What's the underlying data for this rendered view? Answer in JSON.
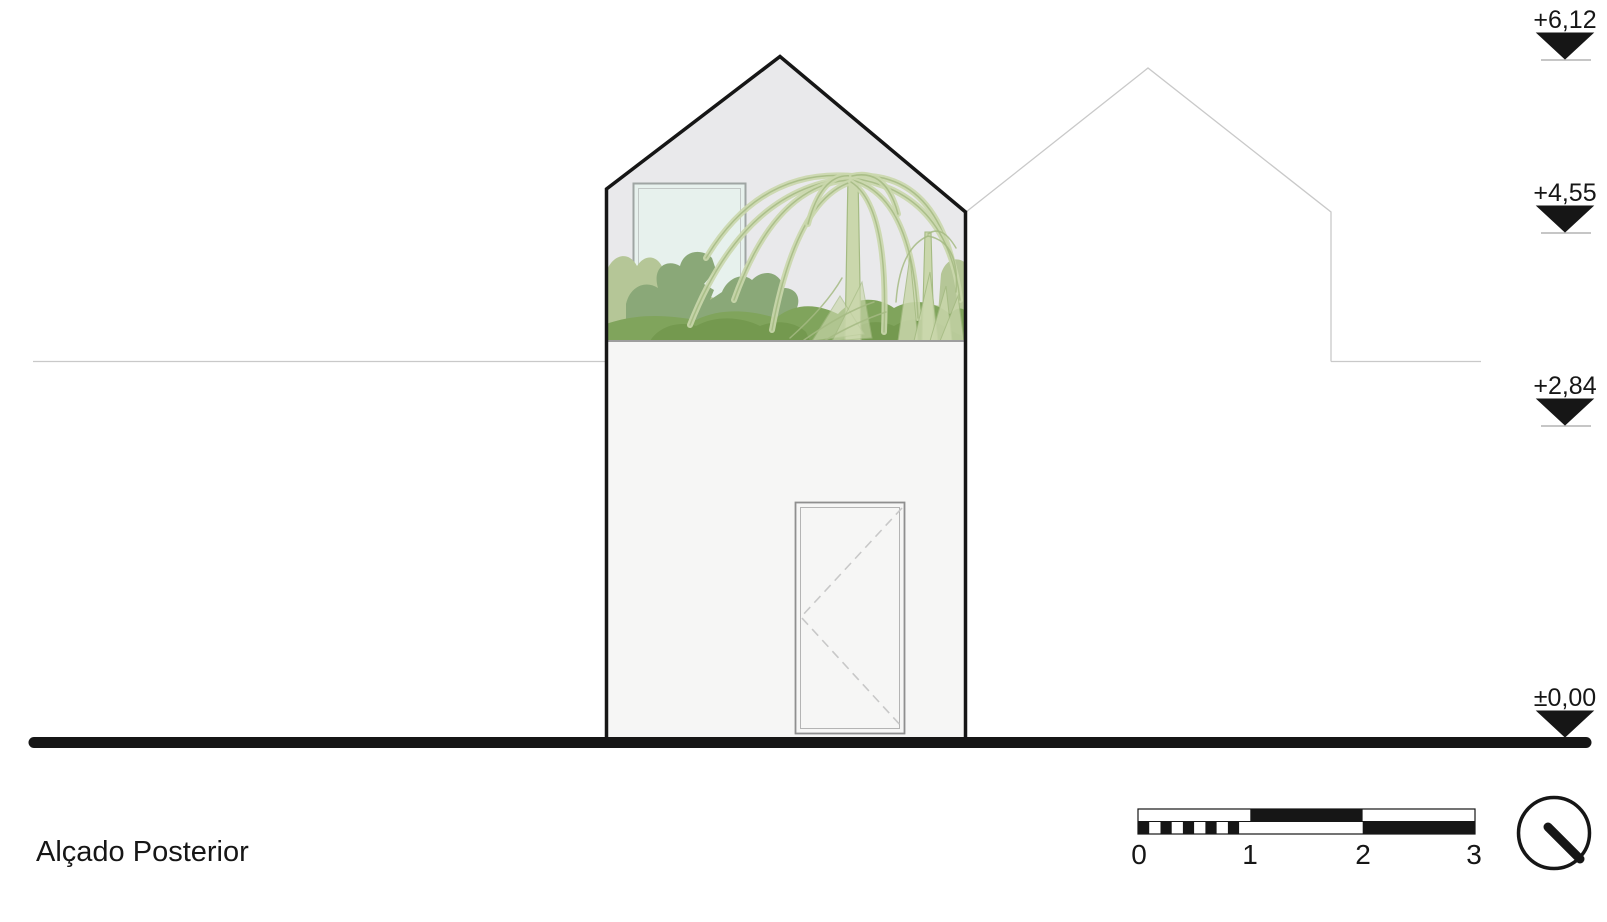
{
  "title": "Alçado Posterior",
  "levels": [
    {
      "label": "+6,12"
    },
    {
      "label": "+4,55"
    },
    {
      "label": "+2,84"
    },
    {
      "label": "±0,00"
    }
  ],
  "scale_bar": {
    "ticks": [
      "0",
      "1",
      "2",
      "3"
    ]
  },
  "colors": {
    "ink": "#161616",
    "faint": "#c9c9c9",
    "ref_line": "#b3b3b3",
    "floor_line": "#9e9e9e",
    "gable_fill": "#e9e9eb",
    "wall_fill": "#f6f6f5",
    "window_fill": "#e7f1ed",
    "window_frame": "#9fa5a3",
    "door_frame": "#8f8f8f",
    "door_dash": "#c8c8c8",
    "green_light": "#b5c697",
    "green_medium": "#8aa878",
    "green_band": "#80a45c",
    "green_dark": "#74994f",
    "palm_fill": "#cad7ac",
    "palm_stroke": "#a4ba82"
  }
}
